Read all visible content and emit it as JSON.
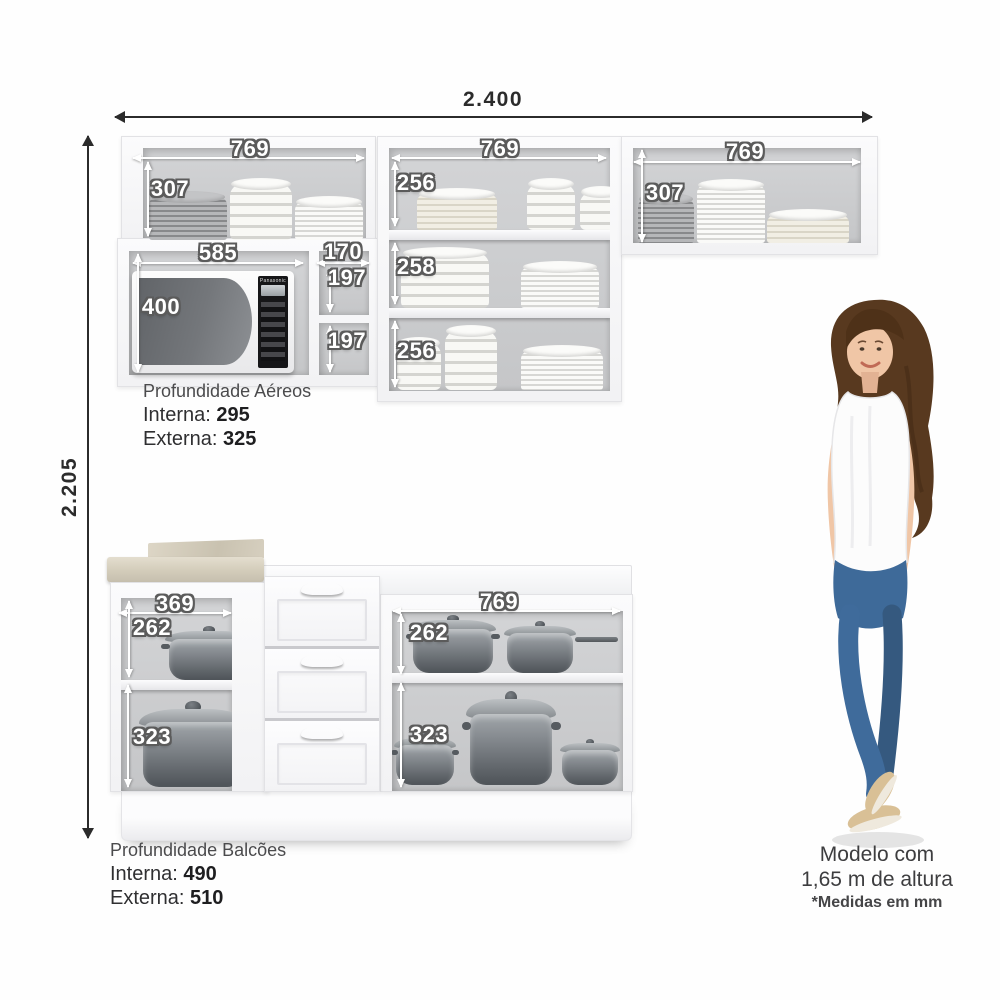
{
  "overall": {
    "width": "2.400",
    "height": "2.205"
  },
  "dims": {
    "upper_left": {
      "w": "769",
      "h": "307"
    },
    "upper_mid": {
      "w": "769",
      "s1": "256",
      "s2": "258",
      "s3": "256"
    },
    "upper_right": {
      "w": "769",
      "h": "307"
    },
    "micro": {
      "w": "585",
      "h": "400",
      "side_w": "170",
      "side_h1": "197",
      "side_h2": "197"
    },
    "lower_left": {
      "w": "369",
      "t": "262",
      "b": "323"
    },
    "lower_right": {
      "w": "769",
      "t": "262",
      "b": "323"
    }
  },
  "captions": {
    "aereos": {
      "title": "Profundidade Aéreos",
      "interna_label": "Interna:",
      "interna": "295",
      "externa_label": "Externa:",
      "externa": "325"
    },
    "balcoes": {
      "title": "Profundidade Balcões",
      "interna_label": "Interna:",
      "interna": "490",
      "externa_label": "Externa:",
      "externa": "510"
    }
  },
  "model": {
    "line1": "Modelo com",
    "line2": "1,65 m de altura",
    "note": "*Medidas em mm"
  },
  "microwave_brand": "Panasonic",
  "colors": {
    "dim_text_dark": "#2b2b2b",
    "dim_text_light": "#ffffff",
    "cabinet_white": "#f6f6f7",
    "cabinet_interior": "#cdced0",
    "marble_top": "#d8d2c3",
    "drawer_handle": "#6b441f",
    "pot_gray": "#62676c",
    "jeans_blue": "#3e6a99",
    "hair_brown": "#58391f",
    "skin": "#f0c6a6",
    "shoe_beige": "#d9c096"
  }
}
